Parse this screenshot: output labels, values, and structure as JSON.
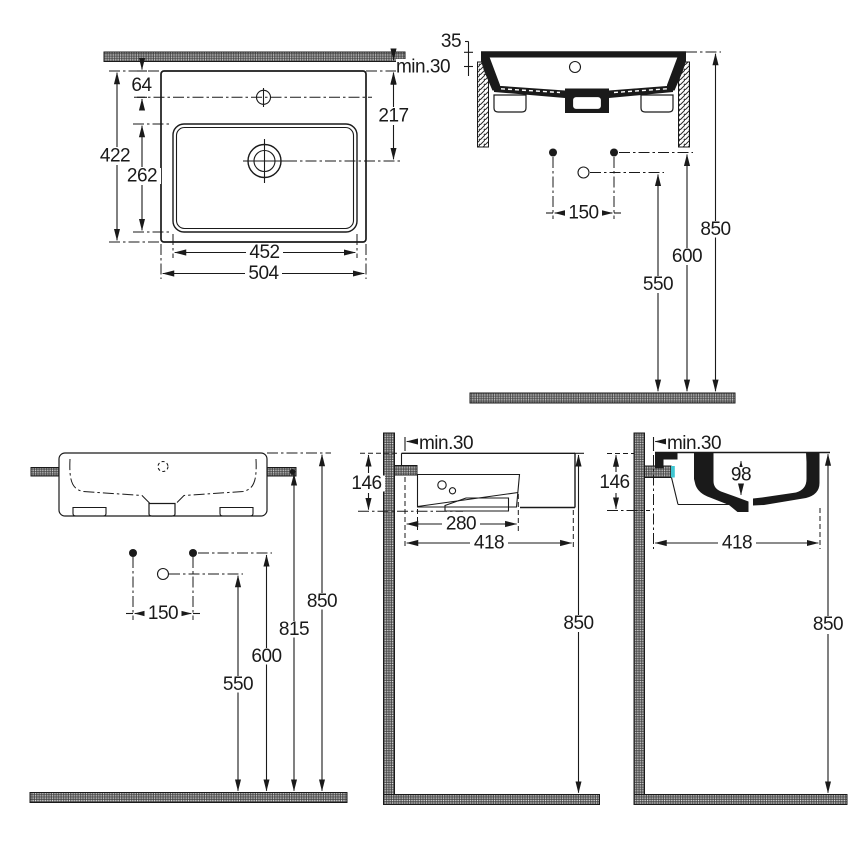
{
  "labels": {
    "plan": {
      "offset_top": "64",
      "depth": "422",
      "bowl_depth": "262",
      "wall_gap": "min.30",
      "drain_offset": "217",
      "bowl_width": "452",
      "width": "504"
    },
    "front_section": {
      "ledge_height": "35",
      "hole_spacing": "150",
      "drain_height": "550",
      "holes_height": "600",
      "rim_height": "850"
    },
    "front_elevation": {
      "hole_spacing": "150",
      "drain_height": "550",
      "holes_height": "600",
      "bracket_height": "815",
      "rim_height": "850"
    },
    "side_view": {
      "wall_gap": "min.30",
      "body_height": "146",
      "bowl_length": "280",
      "total_depth": "418",
      "rim_height": "850"
    },
    "side_section": {
      "wall_gap": "min.30",
      "body_height": "146",
      "inner_depth": "98",
      "total_depth": "418",
      "rim_height": "850"
    }
  },
  "colors": {
    "line": "#1a1a1a",
    "accent": "#3fc6d1",
    "background": "#ffffff"
  }
}
